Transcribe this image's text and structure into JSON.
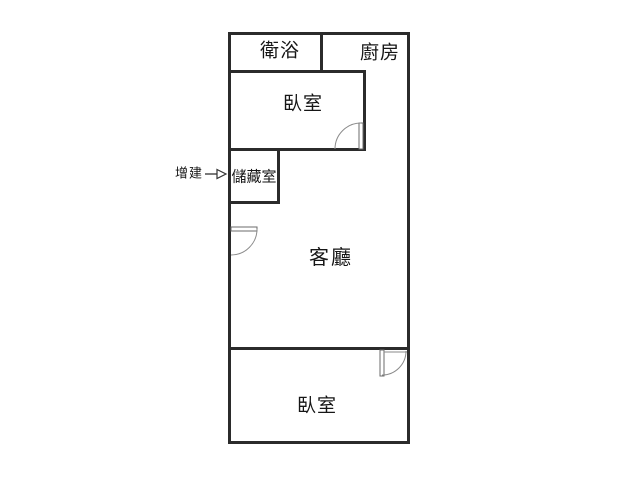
{
  "floor_plan": {
    "rooms": {
      "bathroom": {
        "label": "衛浴"
      },
      "kitchen": {
        "label": "廚房"
      },
      "bedroom_top": {
        "label": "臥室"
      },
      "storage": {
        "label": "儲藏室"
      },
      "living_room": {
        "label": "客廳"
      },
      "bedroom_bottom": {
        "label": "臥室"
      }
    },
    "annotation": {
      "extension_label": "增建",
      "arrow_icon": "right-open-triangle-arrow",
      "points_to": "儲藏室"
    },
    "colors": {
      "wall": "#2b2b2b",
      "door_arc": "#8a8a8a",
      "text": "#161616",
      "background": "#ffffff"
    }
  }
}
